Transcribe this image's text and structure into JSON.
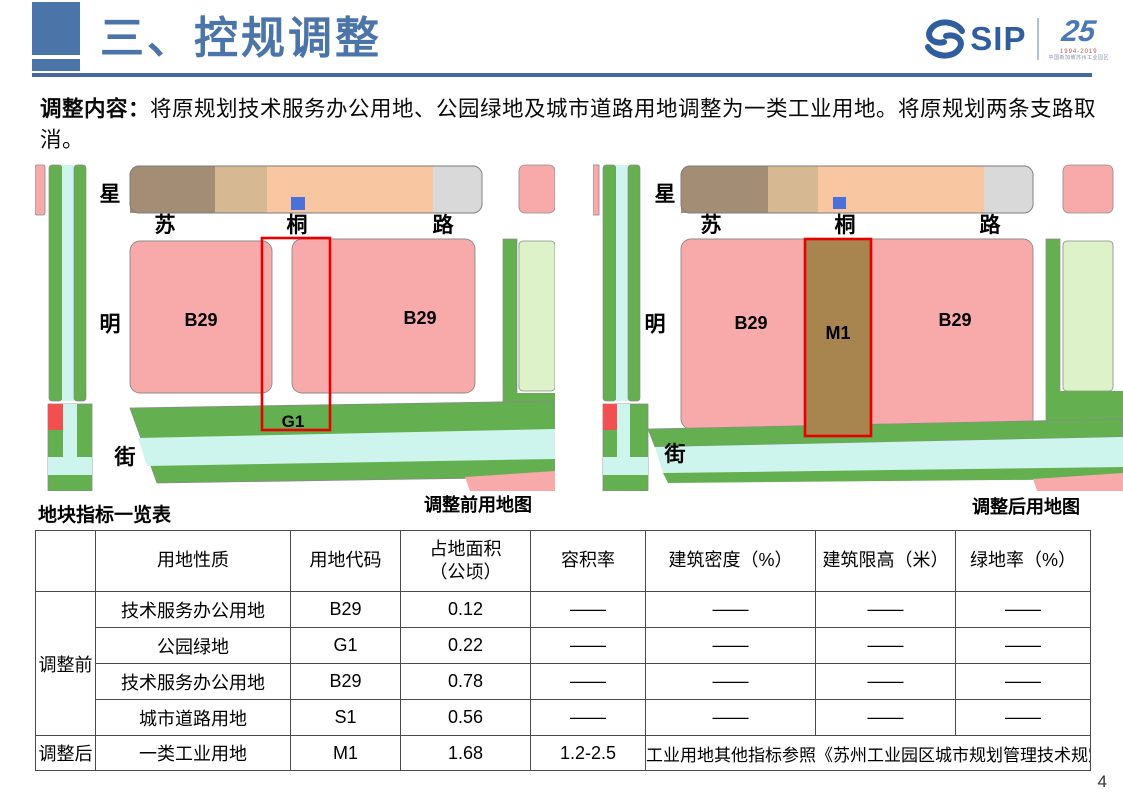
{
  "slide": {
    "title": "三、控规调整",
    "page_number": "4",
    "intro_label": "调整内容：",
    "intro_text": "将原规划技术服务办公用地、公园绿地及城市道路用地调整为一类工业用地。将原规划两条支路取消。"
  },
  "logo": {
    "brand": "SIP",
    "anniversary_number": "25",
    "anniversary_years": "1994-2019",
    "anniversary_org": "中国新加坡苏州工业园区"
  },
  "maps": {
    "before": {
      "caption": "调整前用地图",
      "vertical_street": [
        "星",
        "明",
        "街"
      ],
      "horizontal_road": [
        "苏",
        "桐",
        "路"
      ],
      "parcel_labels": {
        "b29_left": "B29",
        "b29_right": "B29",
        "g1": "G1"
      }
    },
    "after": {
      "caption": "调整后用地图",
      "vertical_street": [
        "星",
        "明",
        "街"
      ],
      "horizontal_road": [
        "苏",
        "桐",
        "路"
      ],
      "parcel_labels": {
        "b29_left": "B29",
        "m1": "M1",
        "b29_right": "B29"
      }
    }
  },
  "table": {
    "title": "地块指标一览表",
    "headers": [
      "",
      "用地性质",
      "用地代码",
      "占地面积\n（公顷）",
      "容积率",
      "建筑密度（%）",
      "建筑限高（米）",
      "绿地率（%）"
    ],
    "before_group": "调整前",
    "before_rows": [
      {
        "use": "技术服务办公用地",
        "code": "B29",
        "area": "0.12",
        "far": "——",
        "density": "——",
        "height": "——",
        "green": "——"
      },
      {
        "use": "公园绿地",
        "code": "G1",
        "area": "0.22",
        "far": "——",
        "density": "——",
        "height": "——",
        "green": "——"
      },
      {
        "use": "技术服务办公用地",
        "code": "B29",
        "area": "0.78",
        "far": "——",
        "density": "——",
        "height": "——",
        "green": "——"
      },
      {
        "use": "城市道路用地",
        "code": "S1",
        "area": "0.56",
        "far": "——",
        "density": "——",
        "height": "——",
        "green": "——"
      }
    ],
    "after_group": "调整后",
    "after_row": {
      "use": "一类工业用地",
      "code": "M1",
      "area": "1.68",
      "far": "1.2-2.5",
      "note": "工业用地其他指标参照《苏州工业园区城市规划管理技术规定》"
    }
  },
  "colors": {
    "accent_blue": "#4B74A8",
    "divider_blue": "#44699E",
    "parcel_pink": "#F8A9A9",
    "parcel_peach": "#F9C6A2",
    "parcel_brown": "#A38D74",
    "parcel_tan": "#D6B992",
    "parcel_gray": "#D9D9D9",
    "road_green": "#64B050",
    "canal_cyan": "#CDF5ED",
    "parcel_lightgreen": "#DDF2C8",
    "m1_brown": "#A8854E",
    "annotation_red": "#E60000",
    "value_red": "#C00000",
    "marker_blue": "#4D6FD9",
    "marker_red": "#F25050"
  }
}
